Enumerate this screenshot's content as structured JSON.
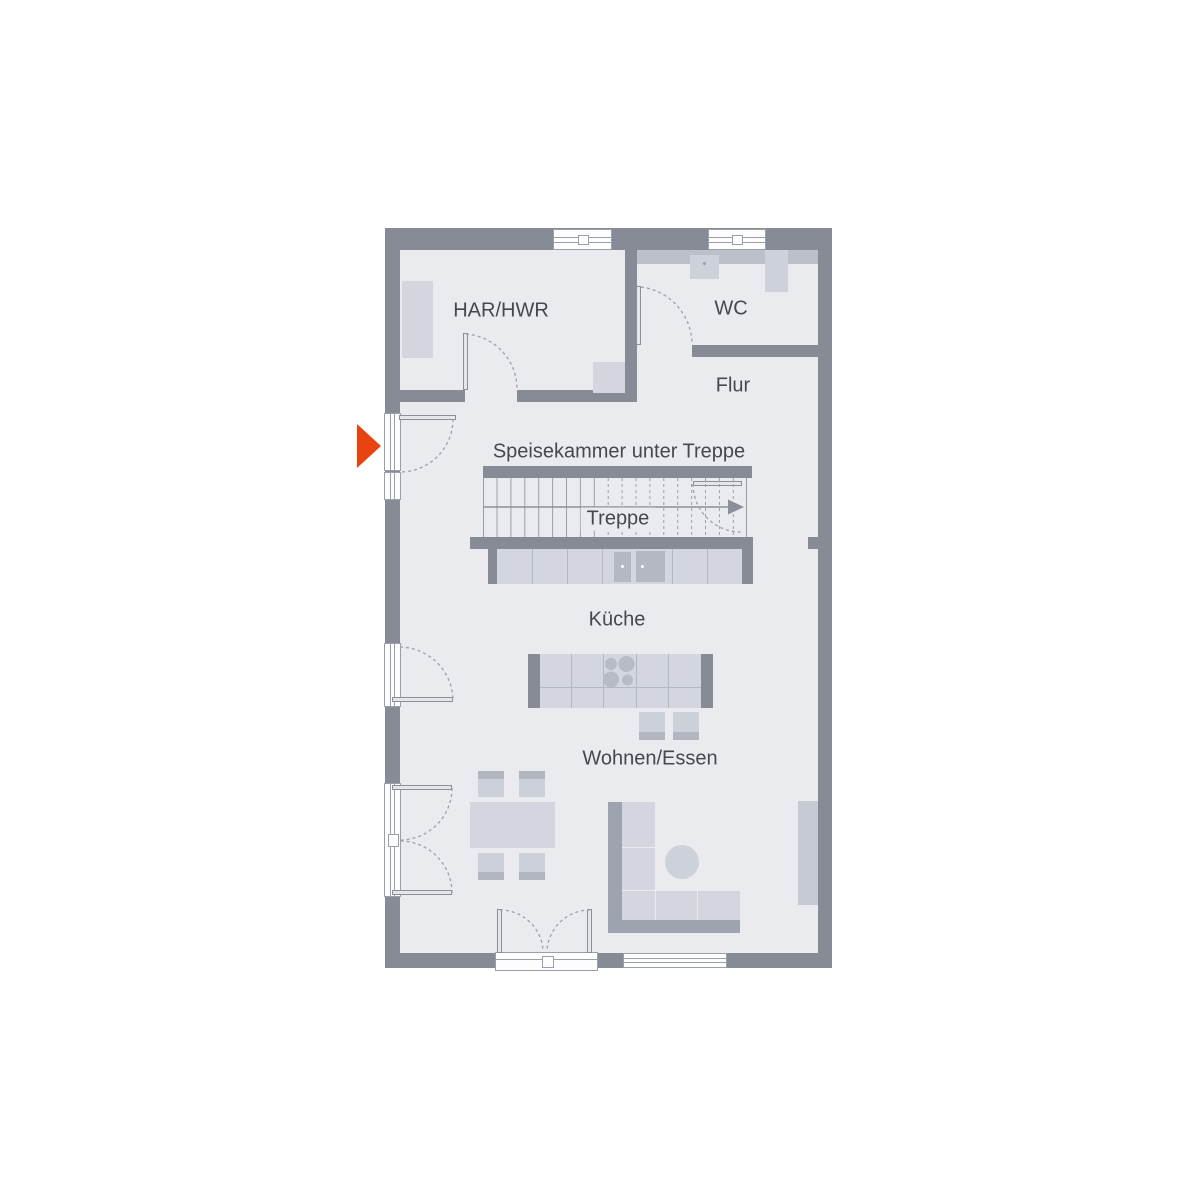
{
  "floorplan": {
    "labels": {
      "har_hwr": "HAR/HWR",
      "wc": "WC",
      "flur": "Flur",
      "speisekammer": "Speisekammer unter Treppe",
      "treppe": "Treppe",
      "kueche": "Küche",
      "wohnen_essen": "Wohnen/Essen"
    },
    "colors": {
      "wall": "#868b96",
      "floor": "#e9ebef",
      "furniture_light": "#d3d6de",
      "furniture_medium": "#bcc0ca",
      "furniture_dark": "#9da3af",
      "entrance_arrow": "#e8430f",
      "label_text": "#45484e"
    }
  }
}
